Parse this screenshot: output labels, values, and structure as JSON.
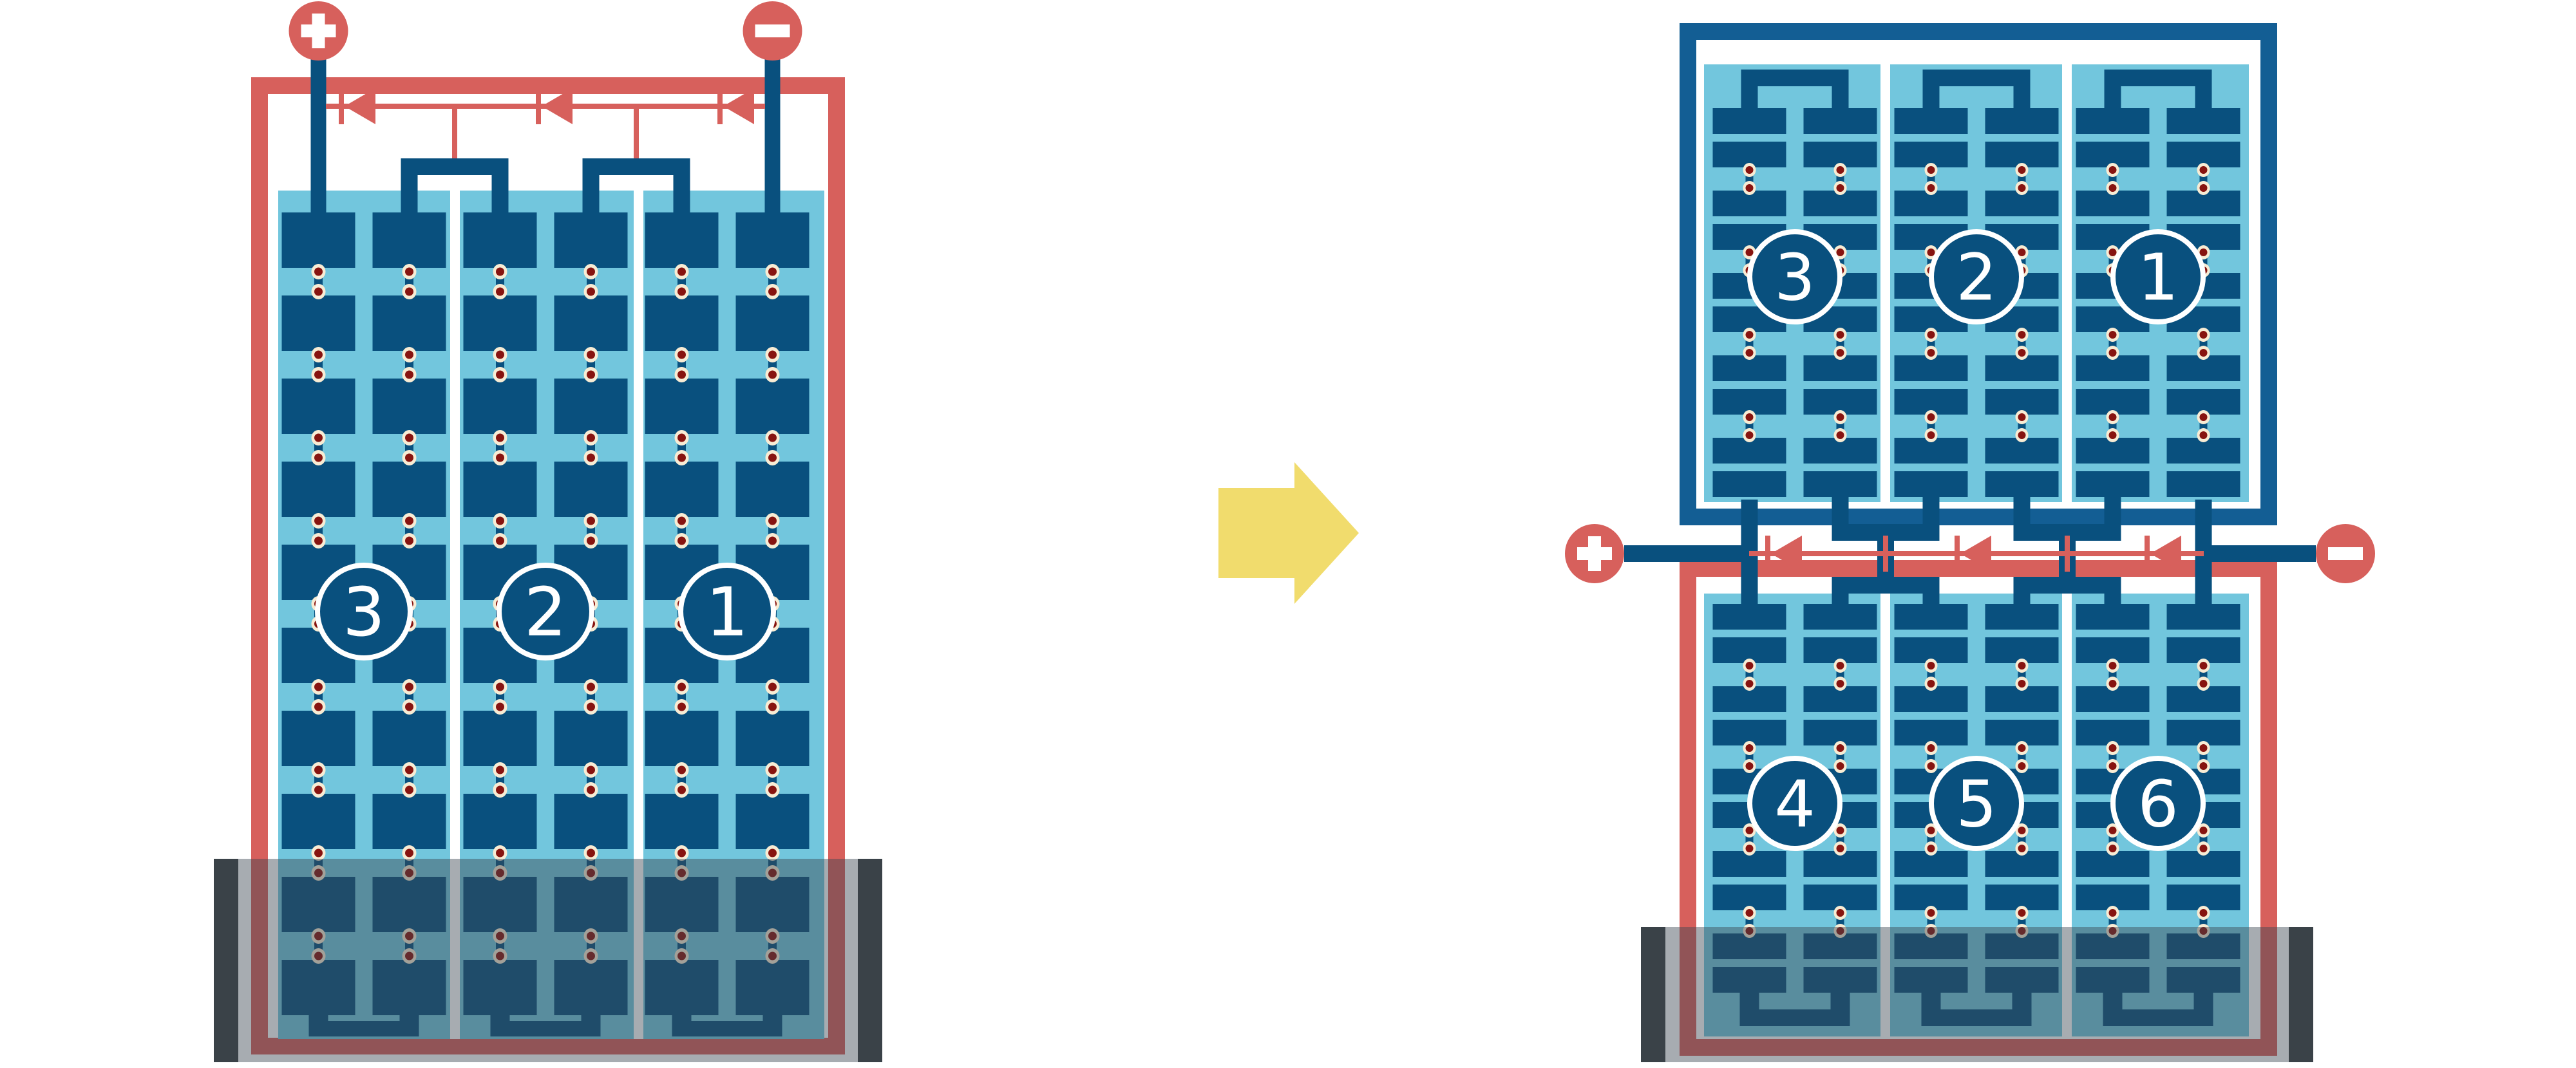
{
  "diagram": {
    "type": "solar-module-wiring-comparison",
    "left_module": {
      "kind": "full-cell-module",
      "plus_symbol": "+",
      "minus_symbol": "−",
      "strings": [
        {
          "label": "3"
        },
        {
          "label": "2"
        },
        {
          "label": "1"
        }
      ],
      "cell_rows_per_column": 10,
      "columns_per_string": 2,
      "bypass_diode_count": 3,
      "shaded_bottom": true
    },
    "right_module": {
      "kind": "half-cut-module",
      "plus_symbol": "+",
      "minus_symbol": "−",
      "top_strings": [
        {
          "label": "3"
        },
        {
          "label": "2"
        },
        {
          "label": "1"
        }
      ],
      "bottom_strings": [
        {
          "label": "4"
        },
        {
          "label": "5"
        },
        {
          "label": "6"
        }
      ],
      "cell_rows_per_half_column": 10,
      "columns_per_string": 2,
      "bypass_diode_count": 3,
      "shaded_bottom": true
    },
    "transform_arrow": "right-arrow",
    "colors": {
      "red": "#D7605C",
      "cell_blue": "#09507E",
      "frame_blue": "#135E94",
      "light_blue": "#72C6DD",
      "cream": "#F8ECD4",
      "dot_red": "#871410",
      "arrow_yellow": "#F1DC6D",
      "shade_cap_gray": "#3A3E41",
      "shade_overlay": "rgba(60,72,82,0.45)",
      "background": "#FFFFFF"
    }
  }
}
